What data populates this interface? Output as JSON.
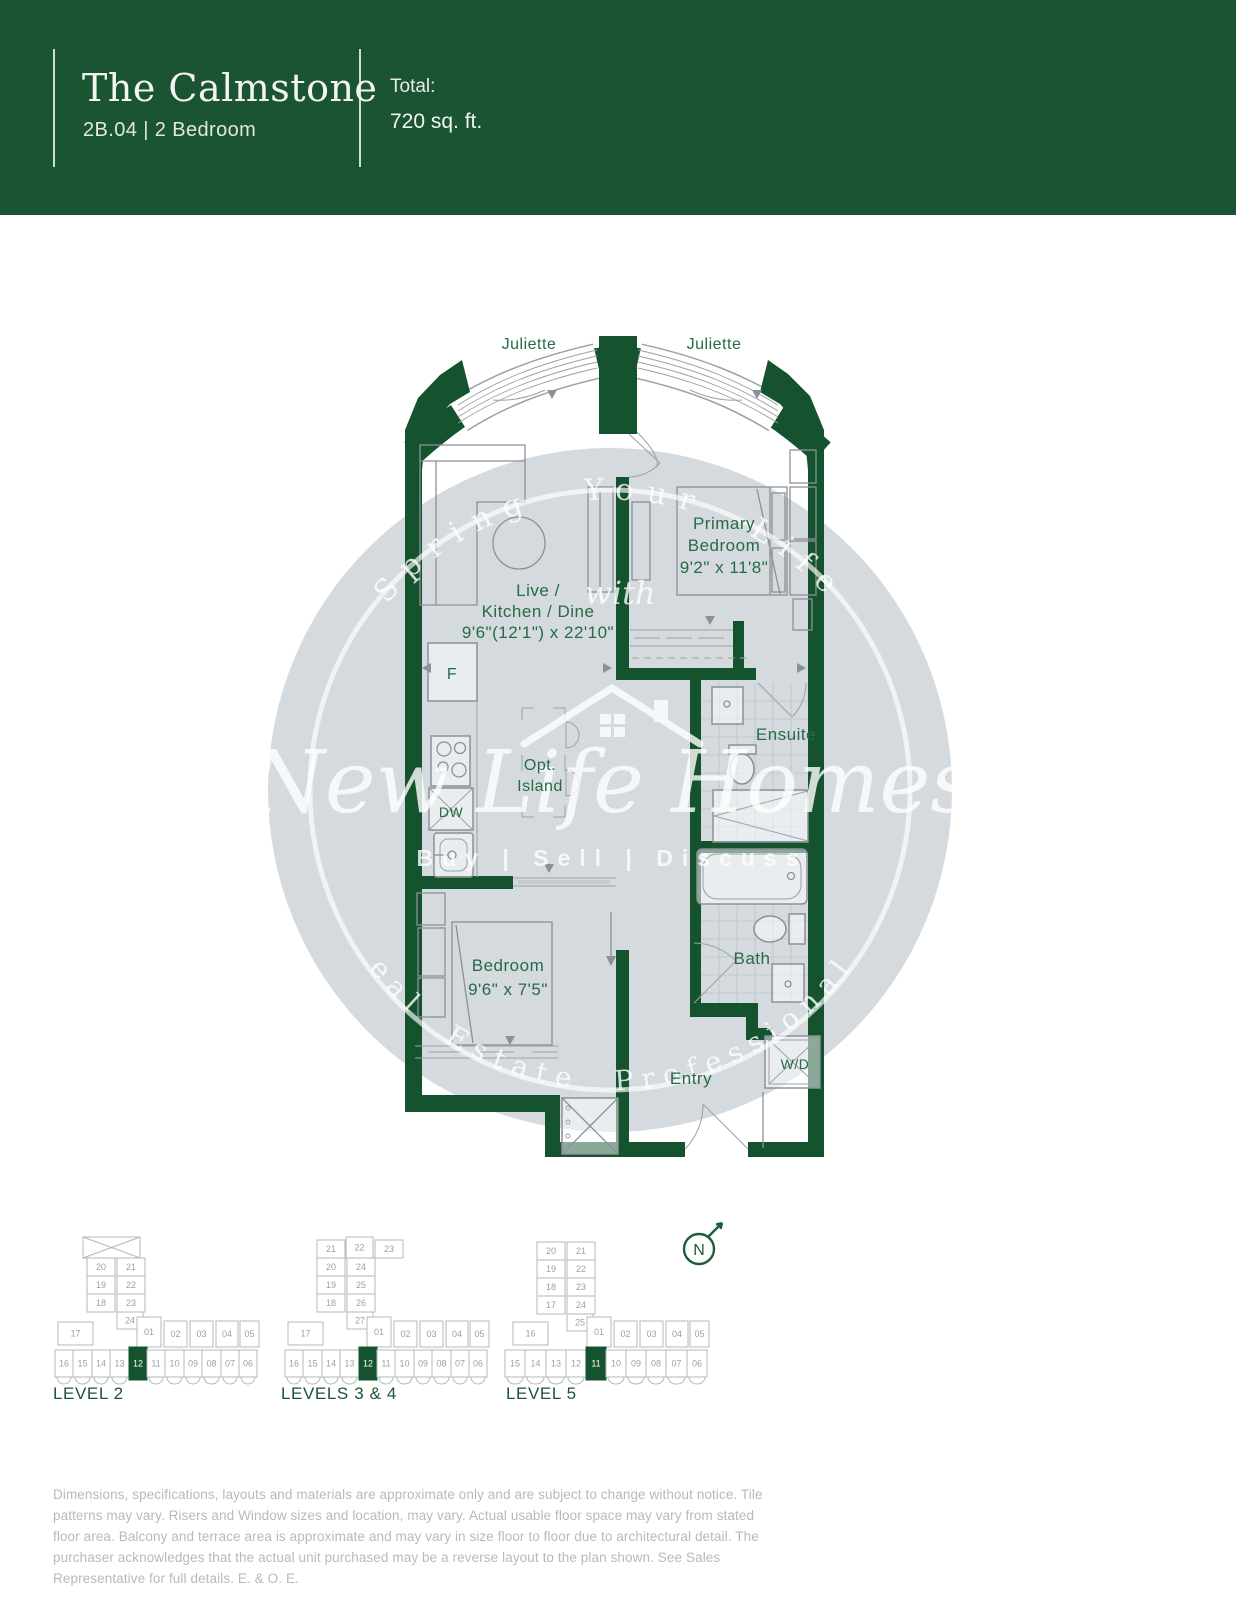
{
  "header": {
    "title": "The Calmstone",
    "subtitle": "2B.04 | 2 Bedroom",
    "total_label": "Total:",
    "total_value": "720 sq. ft."
  },
  "plan": {
    "juliette_left": "Juliette",
    "juliette_right": "Juliette",
    "live_line1": "Live /",
    "live_line2": "Kitchen / Dine",
    "live_dims": "9'6\"(12'1\") x 22'10\"",
    "primary_line1": "Primary",
    "primary_line2": "Bedroom",
    "primary_dims": "9'2\" x 11'8\"",
    "island_line1": "Opt.",
    "island_line2": "Island",
    "ensuite": "Ensuite",
    "bath": "Bath",
    "bedroom": "Bedroom",
    "bedroom_dims": "9'6\" x 7'5\"",
    "entry": "Entry",
    "wd": "W/D",
    "fridge": "F",
    "dishwasher": "DW"
  },
  "watermark": {
    "arc_top": "Spring Your Life",
    "mid_word": "with",
    "brand": "New Life Homes",
    "tagline": "Buy | Sell | Discuss",
    "arc_bottom": "Real Estate Professionals"
  },
  "north": {
    "label": "N"
  },
  "keyplans": {
    "items": [
      {
        "label": "LEVEL 2",
        "origin": {
          "x": 55,
          "y": 1237
        },
        "cross": {
          "x": 28,
          "y": 0,
          "w": 57,
          "h": 21
        },
        "cells": [
          {
            "x": 32,
            "y": 21,
            "w": 28,
            "h": 18,
            "t": "20"
          },
          {
            "x": 62,
            "y": 21,
            "w": 28,
            "h": 18,
            "t": "21"
          },
          {
            "x": 32,
            "y": 39,
            "w": 28,
            "h": 18,
            "t": "19"
          },
          {
            "x": 62,
            "y": 39,
            "w": 28,
            "h": 18,
            "t": "22"
          },
          {
            "x": 32,
            "y": 57,
            "w": 28,
            "h": 18,
            "t": "18"
          },
          {
            "x": 62,
            "y": 57,
            "w": 28,
            "h": 18,
            "t": "23"
          },
          {
            "x": 62,
            "y": 75,
            "w": 26,
            "h": 17,
            "t": "24"
          },
          {
            "x": 3,
            "y": 85,
            "w": 35,
            "h": 23,
            "t": "17"
          },
          {
            "x": 82,
            "y": 80,
            "w": 24,
            "h": 30,
            "t": "01"
          },
          {
            "x": 109,
            "y": 84,
            "w": 23,
            "h": 26,
            "t": "02"
          },
          {
            "x": 135,
            "y": 84,
            "w": 23,
            "h": 26,
            "t": "03"
          },
          {
            "x": 161,
            "y": 84,
            "w": 22,
            "h": 26,
            "t": "04"
          },
          {
            "x": 185,
            "y": 84,
            "w": 19,
            "h": 26,
            "t": "05"
          },
          {
            "x": 0,
            "y": 113,
            "w": 18,
            "h": 27,
            "t": "16",
            "sc": 1
          },
          {
            "x": 18,
            "y": 113,
            "w": 19,
            "h": 27,
            "t": "15",
            "sc": 1
          },
          {
            "x": 37,
            "y": 113,
            "w": 18,
            "h": 27,
            "t": "14",
            "sc": 1
          },
          {
            "x": 55,
            "y": 113,
            "w": 19,
            "h": 27,
            "t": "13",
            "sc": 1
          },
          {
            "x": 74,
            "y": 110,
            "w": 18,
            "h": 33,
            "t": "12",
            "hl": 1
          },
          {
            "x": 92,
            "y": 113,
            "w": 18,
            "h": 27,
            "t": "11",
            "sc": 1
          },
          {
            "x": 110,
            "y": 113,
            "w": 19,
            "h": 27,
            "t": "10",
            "sc": 1
          },
          {
            "x": 129,
            "y": 113,
            "w": 18,
            "h": 27,
            "t": "09",
            "sc": 1
          },
          {
            "x": 147,
            "y": 113,
            "w": 19,
            "h": 27,
            "t": "08",
            "sc": 1
          },
          {
            "x": 166,
            "y": 113,
            "w": 18,
            "h": 27,
            "t": "07",
            "sc": 1
          },
          {
            "x": 184,
            "y": 113,
            "w": 18,
            "h": 27,
            "t": "06",
            "sc": 1
          }
        ]
      },
      {
        "label": "LEVELS 3 & 4",
        "origin": {
          "x": 285,
          "y": 1237
        },
        "cross": null,
        "cells": [
          {
            "x": 32,
            "y": 3,
            "w": 28,
            "h": 18,
            "t": "21"
          },
          {
            "x": 61,
            "y": 0,
            "w": 27,
            "h": 21,
            "t": "22"
          },
          {
            "x": 90,
            "y": 3,
            "w": 28,
            "h": 18,
            "t": "23"
          },
          {
            "x": 32,
            "y": 21,
            "w": 28,
            "h": 18,
            "t": "20"
          },
          {
            "x": 62,
            "y": 21,
            "w": 28,
            "h": 18,
            "t": "24"
          },
          {
            "x": 32,
            "y": 39,
            "w": 28,
            "h": 18,
            "t": "19"
          },
          {
            "x": 62,
            "y": 39,
            "w": 28,
            "h": 18,
            "t": "25"
          },
          {
            "x": 32,
            "y": 57,
            "w": 28,
            "h": 18,
            "t": "18"
          },
          {
            "x": 62,
            "y": 57,
            "w": 28,
            "h": 18,
            "t": "26"
          },
          {
            "x": 62,
            "y": 75,
            "w": 26,
            "h": 17,
            "t": "27"
          },
          {
            "x": 3,
            "y": 85,
            "w": 35,
            "h": 23,
            "t": "17"
          },
          {
            "x": 82,
            "y": 80,
            "w": 24,
            "h": 30,
            "t": "01"
          },
          {
            "x": 109,
            "y": 84,
            "w": 23,
            "h": 26,
            "t": "02"
          },
          {
            "x": 135,
            "y": 84,
            "w": 23,
            "h": 26,
            "t": "03"
          },
          {
            "x": 161,
            "y": 84,
            "w": 22,
            "h": 26,
            "t": "04"
          },
          {
            "x": 185,
            "y": 84,
            "w": 19,
            "h": 26,
            "t": "05"
          },
          {
            "x": 0,
            "y": 113,
            "w": 18,
            "h": 27,
            "t": "16",
            "sc": 1
          },
          {
            "x": 18,
            "y": 113,
            "w": 19,
            "h": 27,
            "t": "15",
            "sc": 1
          },
          {
            "x": 37,
            "y": 113,
            "w": 18,
            "h": 27,
            "t": "14",
            "sc": 1
          },
          {
            "x": 55,
            "y": 113,
            "w": 19,
            "h": 27,
            "t": "13",
            "sc": 1
          },
          {
            "x": 74,
            "y": 110,
            "w": 18,
            "h": 33,
            "t": "12",
            "hl": 1
          },
          {
            "x": 92,
            "y": 113,
            "w": 18,
            "h": 27,
            "t": "11",
            "sc": 1
          },
          {
            "x": 110,
            "y": 113,
            "w": 19,
            "h": 27,
            "t": "10",
            "sc": 1
          },
          {
            "x": 129,
            "y": 113,
            "w": 18,
            "h": 27,
            "t": "09",
            "sc": 1
          },
          {
            "x": 147,
            "y": 113,
            "w": 19,
            "h": 27,
            "t": "08",
            "sc": 1
          },
          {
            "x": 166,
            "y": 113,
            "w": 18,
            "h": 27,
            "t": "07",
            "sc": 1
          },
          {
            "x": 184,
            "y": 113,
            "w": 18,
            "h": 27,
            "t": "06",
            "sc": 1
          }
        ]
      },
      {
        "label": "LEVEL 5",
        "origin": {
          "x": 505,
          "y": 1237
        },
        "cross": null,
        "cells": [
          {
            "x": 32,
            "y": 5,
            "w": 28,
            "h": 18,
            "t": "20"
          },
          {
            "x": 62,
            "y": 5,
            "w": 28,
            "h": 18,
            "t": "21"
          },
          {
            "x": 32,
            "y": 23,
            "w": 28,
            "h": 18,
            "t": "19"
          },
          {
            "x": 62,
            "y": 23,
            "w": 28,
            "h": 18,
            "t": "22"
          },
          {
            "x": 32,
            "y": 41,
            "w": 28,
            "h": 18,
            "t": "18"
          },
          {
            "x": 62,
            "y": 41,
            "w": 28,
            "h": 18,
            "t": "23"
          },
          {
            "x": 32,
            "y": 59,
            "w": 28,
            "h": 18,
            "t": "17"
          },
          {
            "x": 62,
            "y": 59,
            "w": 28,
            "h": 18,
            "t": "24"
          },
          {
            "x": 62,
            "y": 77,
            "w": 26,
            "h": 17,
            "t": "25"
          },
          {
            "x": 8,
            "y": 85,
            "w": 35,
            "h": 23,
            "t": "16"
          },
          {
            "x": 82,
            "y": 80,
            "w": 24,
            "h": 30,
            "t": "01"
          },
          {
            "x": 109,
            "y": 84,
            "w": 23,
            "h": 26,
            "t": "02"
          },
          {
            "x": 135,
            "y": 84,
            "w": 23,
            "h": 26,
            "t": "03"
          },
          {
            "x": 161,
            "y": 84,
            "w": 22,
            "h": 26,
            "t": "04"
          },
          {
            "x": 185,
            "y": 84,
            "w": 19,
            "h": 26,
            "t": "05"
          },
          {
            "x": 0,
            "y": 113,
            "w": 20,
            "h": 27,
            "t": "15",
            "sc": 1
          },
          {
            "x": 20,
            "y": 113,
            "w": 21,
            "h": 27,
            "t": "14",
            "sc": 1
          },
          {
            "x": 41,
            "y": 113,
            "w": 20,
            "h": 27,
            "t": "13",
            "sc": 1
          },
          {
            "x": 61,
            "y": 113,
            "w": 20,
            "h": 27,
            "t": "12",
            "sc": 1
          },
          {
            "x": 81,
            "y": 110,
            "w": 20,
            "h": 33,
            "t": "11",
            "hl": 1
          },
          {
            "x": 101,
            "y": 113,
            "w": 20,
            "h": 27,
            "t": "10",
            "sc": 1
          },
          {
            "x": 121,
            "y": 113,
            "w": 20,
            "h": 27,
            "t": "09",
            "sc": 1
          },
          {
            "x": 141,
            "y": 113,
            "w": 20,
            "h": 27,
            "t": "08",
            "sc": 1
          },
          {
            "x": 161,
            "y": 113,
            "w": 21,
            "h": 27,
            "t": "07",
            "sc": 1
          },
          {
            "x": 182,
            "y": 113,
            "w": 20,
            "h": 27,
            "t": "06",
            "sc": 1
          }
        ]
      }
    ]
  },
  "disclaimer": "Dimensions, specifications, layouts and materials are approximate only and are subject to change without notice. Tile patterns may vary. Risers and Window sizes and location, may vary. Actual usable floor space may vary from stated floor area. Balcony and terrace area is approximate and may vary in size floor to floor due to architectural detail. The purchaser acknowledges that the actual unit purchased may be a reverse layout to the plan shown. See Sales Representative for full details. E. & O. E."
}
